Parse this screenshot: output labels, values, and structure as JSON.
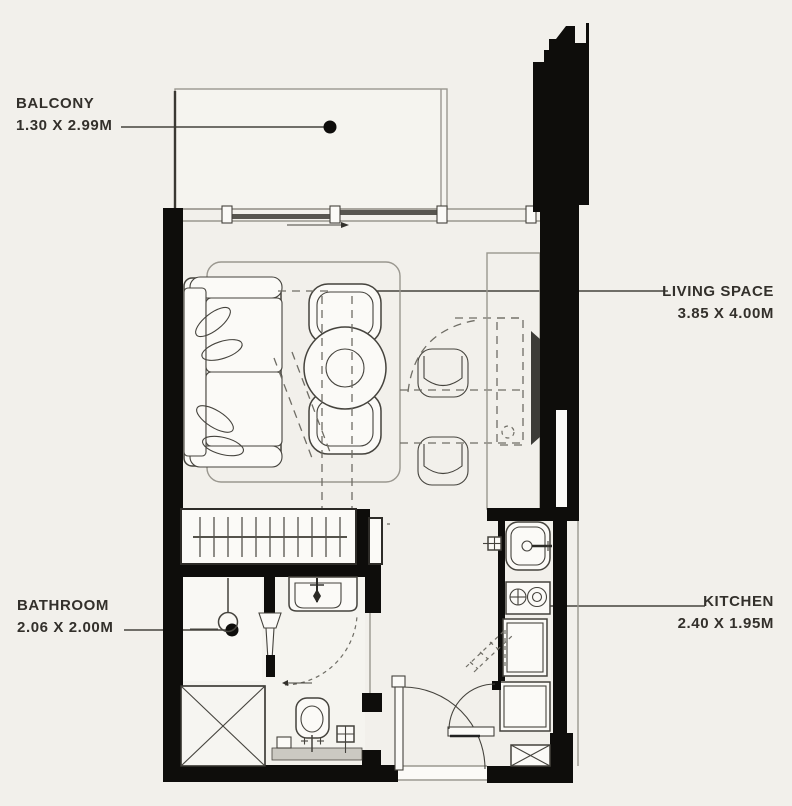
{
  "document_type": "apartment floor plan",
  "colors": {
    "background": "#f2f0eb",
    "wall": "#0e0d0b",
    "ink": "#45433d",
    "muted": "#9a978f",
    "dash": "#6f6d65",
    "text": "#33302b",
    "paper": "#fbfaf7"
  },
  "rooms": [
    {
      "id": "balcony",
      "label": "BALCONY",
      "dimensions": "1.30 X 2.99M"
    },
    {
      "id": "living-space",
      "label": "LIVING SPACE",
      "dimensions": "3.85 X 4.00M"
    },
    {
      "id": "bathroom",
      "label": "BATHROOM",
      "dimensions": "2.06 X 2.00M"
    },
    {
      "id": "kitchen",
      "label": "KITCHEN",
      "dimensions": "2.40 X 1.95M"
    }
  ]
}
